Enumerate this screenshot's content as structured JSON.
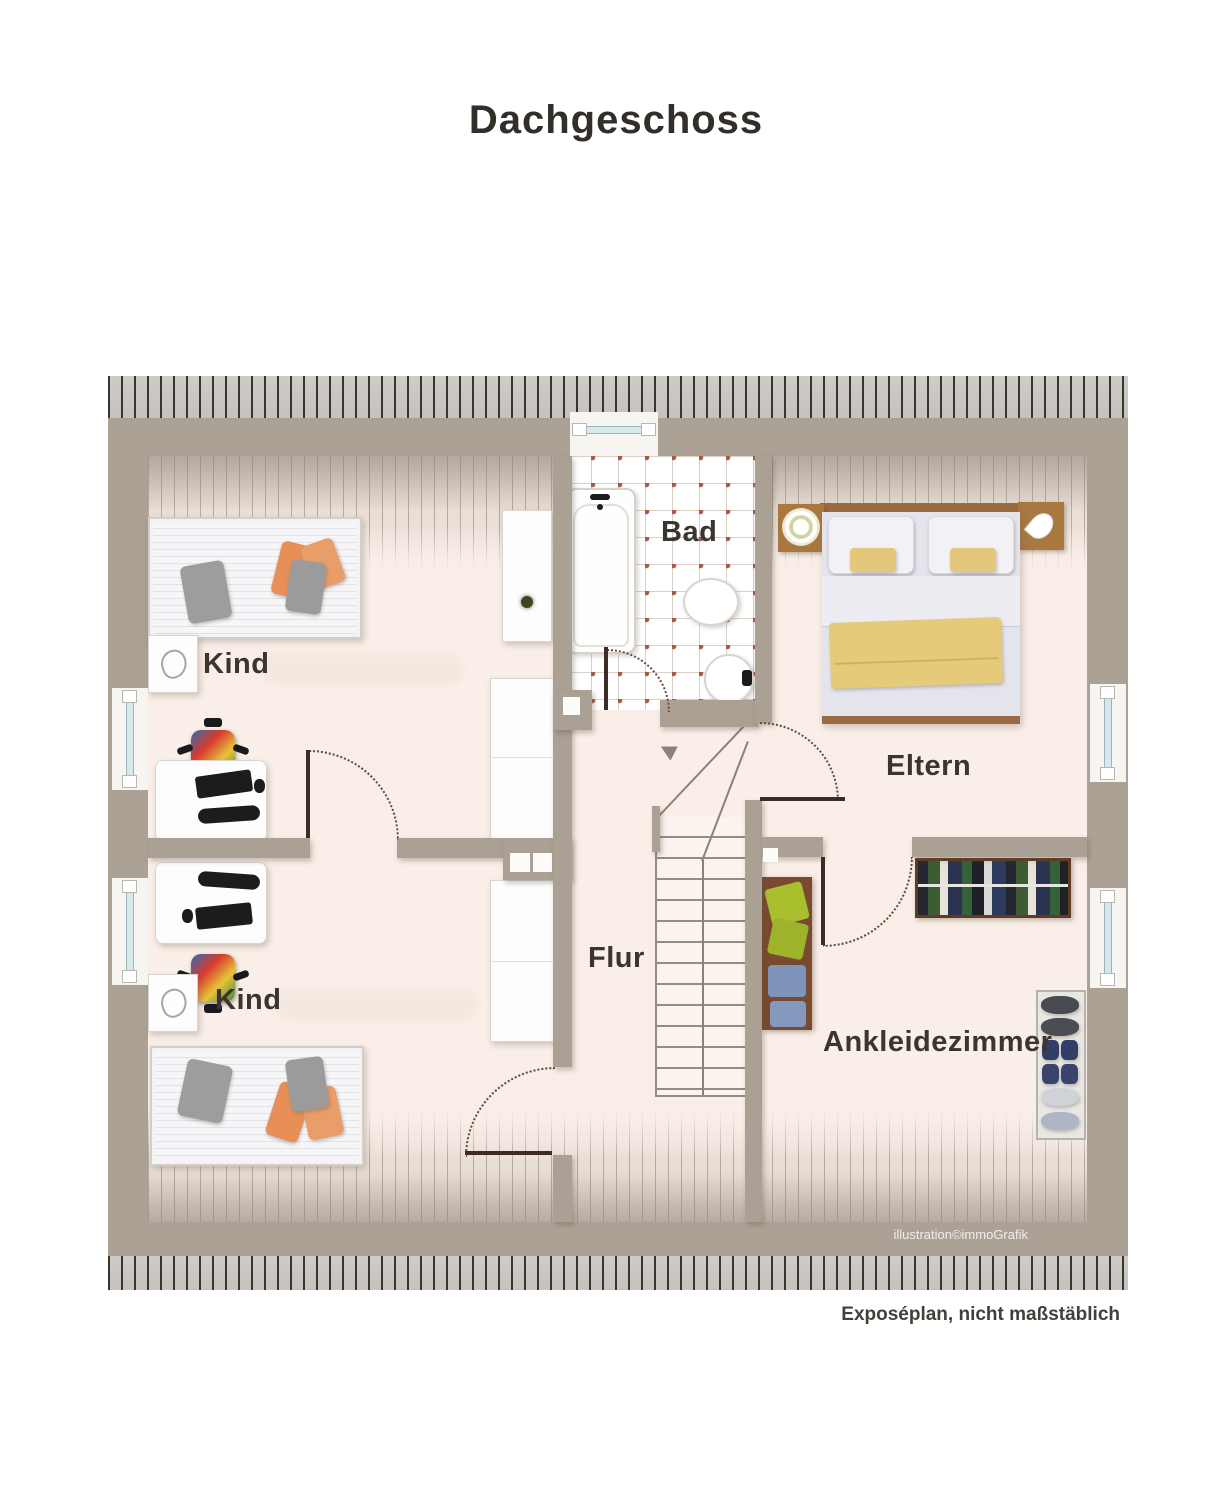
{
  "title": "Dachgeschoss",
  "rooms": {
    "kind1": "Kind",
    "kind2": "Kind",
    "bad": "Bad",
    "eltern": "Eltern",
    "flur": "Flur",
    "ankleidezimmer": "Ankleidezimmer"
  },
  "credit": "illustration©immoGrafik",
  "footnote": "Exposéplan, nicht maßstäblich",
  "colors": {
    "wall": "#aba094",
    "floor": "#f9efe8",
    "hatch_line": "#393631",
    "tile_accent": "#a55a47",
    "door": "#3f2b26",
    "wood": "#9a6b42",
    "accent_orange": "#e79058",
    "accent_yellow": "#e5ca7a",
    "accent_green": "#a9bf2e",
    "accent_blue": "#7e94ba"
  }
}
